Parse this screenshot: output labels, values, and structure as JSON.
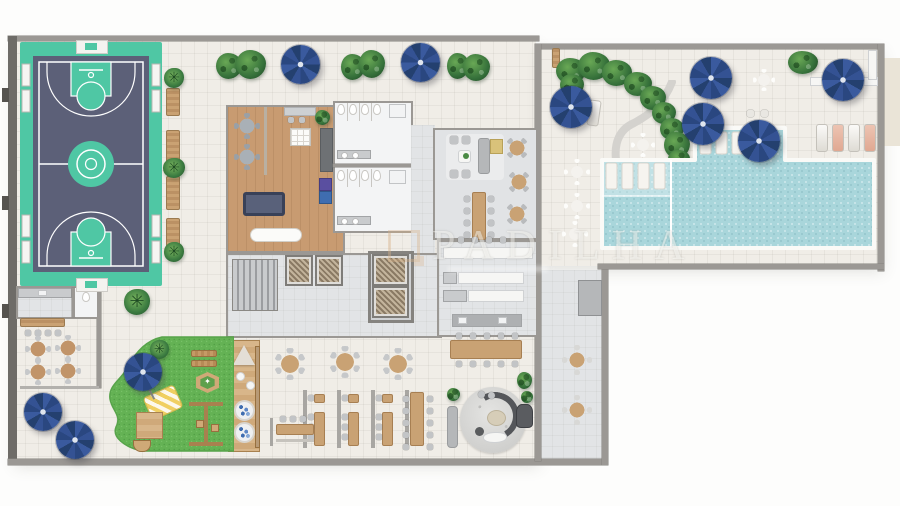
{
  "watermark": {
    "text": "PADILHA",
    "logo": "tan-square-outline-monogram"
  },
  "palette": {
    "background": "#fdfdfc",
    "deck_floor": "#f0ede7",
    "room_gray": "#e2e4e6",
    "bathroom_white": "#f3f4f5",
    "wood_floor": "#c89b71",
    "wall": "#9b9894",
    "wall_dark": "#6e6c68",
    "court_base": "#4fc7a4",
    "court_inner": "#5c6078",
    "court_line": "#ffffff",
    "pool_water": "#a9d6db",
    "pool_shallow": "#c3e3e6",
    "umbrella_blue": "#2f4d8e",
    "lawn_green": "#64b254",
    "plant_green": "#35703a",
    "furniture_gray": "#c2c4c6",
    "furniture_wood": "#c9a274"
  },
  "areas": [
    "sports-court",
    "side-walkway",
    "games-lounge",
    "restrooms",
    "stairs-elevator-core",
    "party-room",
    "kitchen",
    "restaurant-terrace",
    "family-lounge",
    "kids-playroom-deck",
    "playground-lawn",
    "outdoor-cafe",
    "support-pantry",
    "gourmet-terrace",
    "pool-deck",
    "swimming-pool",
    "kids-pool-shelf",
    "sun-deck"
  ],
  "inventory": {
    "blue_umbrellas": 10,
    "pool_sun_loungers_in_water": 7,
    "deck_sun_loungers": 4,
    "walkway_benches": 4,
    "round_restaurant_tables": 3,
    "booth_partitions": 4,
    "elevators": 4,
    "basketball_courts": 1,
    "swimming_pools": 1
  }
}
